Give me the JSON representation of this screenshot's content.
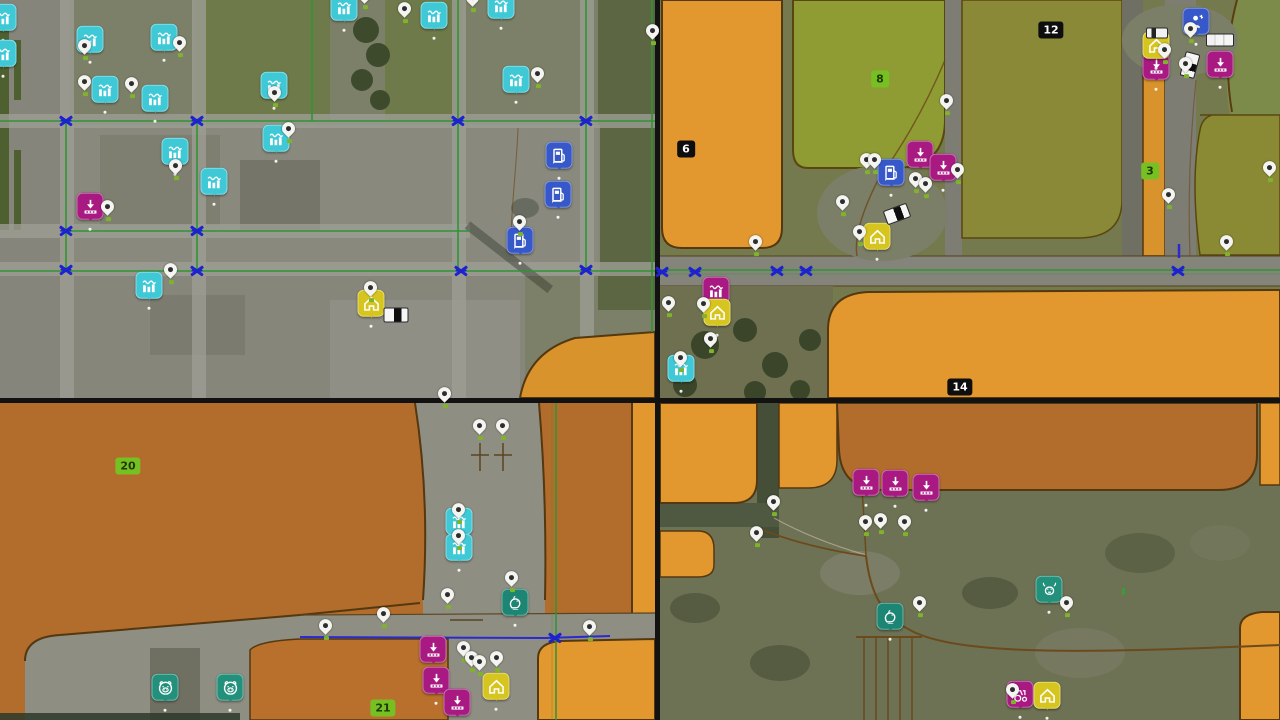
{
  "map": {
    "description": "four-view game map collage",
    "colors": {
      "cyan": "#3fc9d6",
      "blue": "#3758c8",
      "magenta": "#a81a82",
      "yellow": "#d6c51f",
      "teal": "#23907c",
      "teal_dark": "#1d8573",
      "junction_blue": "#1d22cf",
      "route_green": "#2f9435",
      "route_blue": "#2a2ad0",
      "orange_bright": "#e2972f",
      "orange_dark": "#b26c2c",
      "olive_field": "#8a8a35",
      "badge_green": "#76c023",
      "badge_dark": "#0e0e0e",
      "pin_white": "#f4f4f1"
    },
    "fields": [
      {
        "label": "6",
        "variant": "dark",
        "x": 686,
        "y": 149
      },
      {
        "label": "8",
        "variant": "green",
        "x": 880,
        "y": 79
      },
      {
        "label": "12",
        "variant": "dark",
        "x": 1051,
        "y": 30
      },
      {
        "label": "3",
        "variant": "green",
        "x": 1150,
        "y": 171
      },
      {
        "label": "14",
        "variant": "dark",
        "x": 960,
        "y": 387
      },
      {
        "label": "20",
        "variant": "green",
        "x": 128,
        "y": 466
      },
      {
        "label": "21",
        "variant": "green",
        "x": 383,
        "y": 708
      }
    ],
    "markers": [
      {
        "t": "prod",
        "x": 3,
        "y": 20
      },
      {
        "t": "prod",
        "x": 3,
        "y": 56
      },
      {
        "t": "prod",
        "x": 90,
        "y": 42
      },
      {
        "t": "prod",
        "x": 164,
        "y": 40
      },
      {
        "t": "prod",
        "x": 105,
        "y": 92
      },
      {
        "t": "prod",
        "x": 155,
        "y": 101
      },
      {
        "t": "prod",
        "x": 274,
        "y": 88
      },
      {
        "t": "prod",
        "x": 276,
        "y": 141
      },
      {
        "t": "prod",
        "x": 175,
        "y": 154
      },
      {
        "t": "prod",
        "x": 214,
        "y": 184
      },
      {
        "t": "prod",
        "x": 344,
        "y": 10
      },
      {
        "t": "prod",
        "x": 434,
        "y": 18
      },
      {
        "t": "prod",
        "x": 501,
        "y": 8
      },
      {
        "t": "prod",
        "x": 516,
        "y": 82
      },
      {
        "t": "prod",
        "x": 149,
        "y": 288
      },
      {
        "t": "fuel",
        "x": 559,
        "y": 158
      },
      {
        "t": "fuel",
        "x": 558,
        "y": 197
      },
      {
        "t": "fuel",
        "x": 520,
        "y": 243
      },
      {
        "t": "sell",
        "x": 90,
        "y": 209
      },
      {
        "t": "house",
        "x": 371,
        "y": 306
      },
      {
        "t": "ptruck",
        "x": 396,
        "y": 315,
        "r": 0
      },
      {
        "t": "jx",
        "x": 66,
        "y": 121
      },
      {
        "t": "jx",
        "x": 197,
        "y": 121
      },
      {
        "t": "jx",
        "x": 458,
        "y": 121
      },
      {
        "t": "jx",
        "x": 586,
        "y": 121
      },
      {
        "t": "jx",
        "x": 66,
        "y": 231
      },
      {
        "t": "jx",
        "x": 197,
        "y": 231
      },
      {
        "t": "jx",
        "x": 66,
        "y": 270
      },
      {
        "t": "jx",
        "x": 197,
        "y": 271
      },
      {
        "t": "jx",
        "x": 461,
        "y": 271
      },
      {
        "t": "jx",
        "x": 586,
        "y": 270
      },
      {
        "t": "pin",
        "x": 85,
        "y": 57
      },
      {
        "t": "pin",
        "x": 180,
        "y": 54
      },
      {
        "t": "pin",
        "x": 85,
        "y": 93
      },
      {
        "t": "pin",
        "x": 132,
        "y": 95
      },
      {
        "t": "pin",
        "x": 275,
        "y": 104
      },
      {
        "t": "pin",
        "x": 289,
        "y": 140
      },
      {
        "t": "pin",
        "x": 176,
        "y": 177
      },
      {
        "t": "pin",
        "x": 405,
        "y": 20
      },
      {
        "t": "pin",
        "x": 473,
        "y": 9
      },
      {
        "t": "pin",
        "x": 538,
        "y": 85
      },
      {
        "t": "pin",
        "x": 520,
        "y": 233
      },
      {
        "t": "pin",
        "x": 108,
        "y": 218
      },
      {
        "t": "pin",
        "x": 171,
        "y": 281
      },
      {
        "t": "pin",
        "x": 365,
        "y": 6
      },
      {
        "t": "pin",
        "x": 653,
        "y": 42
      },
      {
        "t": "pin",
        "x": 371,
        "y": 299
      },
      {
        "t": "prod",
        "x": 681,
        "y": 371
      },
      {
        "t": "fuel",
        "x": 891,
        "y": 175
      },
      {
        "t": "sell",
        "x": 920,
        "y": 157
      },
      {
        "t": "sell",
        "x": 943,
        "y": 170
      },
      {
        "t": "sell",
        "x": 1220,
        "y": 67
      },
      {
        "t": "sell",
        "x": 1156,
        "y": 69
      },
      {
        "t": "prodm",
        "x": 716,
        "y": 293
      },
      {
        "t": "house",
        "x": 877,
        "y": 239
      },
      {
        "t": "house",
        "x": 717,
        "y": 315
      },
      {
        "t": "house",
        "x": 1156,
        "y": 48
      },
      {
        "t": "shop",
        "x": 1196,
        "y": 24
      },
      {
        "t": "car",
        "x": 1157,
        "y": 33,
        "r": 0
      },
      {
        "t": "truck",
        "x": 1220,
        "y": 40,
        "r": 0
      },
      {
        "t": "ptruck",
        "x": 1190,
        "y": 65,
        "r": 105
      },
      {
        "t": "ptruck",
        "x": 897,
        "y": 214,
        "r": -20
      },
      {
        "t": "jx",
        "x": 662,
        "y": 272
      },
      {
        "t": "jx",
        "x": 695,
        "y": 272
      },
      {
        "t": "jx",
        "x": 777,
        "y": 271
      },
      {
        "t": "jx",
        "x": 806,
        "y": 271
      },
      {
        "t": "jx",
        "x": 1178,
        "y": 271
      },
      {
        "t": "pin",
        "x": 947,
        "y": 112
      },
      {
        "t": "pin",
        "x": 867,
        "y": 171
      },
      {
        "t": "pin",
        "x": 875,
        "y": 171
      },
      {
        "t": "pin",
        "x": 958,
        "y": 181
      },
      {
        "t": "pin",
        "x": 916,
        "y": 190
      },
      {
        "t": "pin",
        "x": 926,
        "y": 195
      },
      {
        "t": "pin",
        "x": 843,
        "y": 213
      },
      {
        "t": "pin",
        "x": 860,
        "y": 243
      },
      {
        "t": "pin",
        "x": 1165,
        "y": 61
      },
      {
        "t": "pin",
        "x": 1191,
        "y": 40
      },
      {
        "t": "pin",
        "x": 1186,
        "y": 75
      },
      {
        "t": "pin",
        "x": 1169,
        "y": 206
      },
      {
        "t": "pin",
        "x": 1227,
        "y": 253
      },
      {
        "t": "pin",
        "x": 1270,
        "y": 179
      },
      {
        "t": "pin",
        "x": 756,
        "y": 253
      },
      {
        "t": "pin",
        "x": 669,
        "y": 314
      },
      {
        "t": "pin",
        "x": 704,
        "y": 315
      },
      {
        "t": "pin",
        "x": 711,
        "y": 350
      },
      {
        "t": "pin",
        "x": 681,
        "y": 369
      },
      {
        "t": "prod",
        "x": 459,
        "y": 524
      },
      {
        "t": "prod",
        "x": 459,
        "y": 550
      },
      {
        "t": "sell",
        "x": 433,
        "y": 652
      },
      {
        "t": "sell",
        "x": 436,
        "y": 683
      },
      {
        "t": "sell",
        "x": 457,
        "y": 705
      },
      {
        "t": "house",
        "x": 496,
        "y": 689
      },
      {
        "t": "hen",
        "x": 515,
        "y": 605
      },
      {
        "t": "pig",
        "x": 165,
        "y": 690
      },
      {
        "t": "pig",
        "x": 230,
        "y": 690
      },
      {
        "t": "jx",
        "x": 555,
        "y": 638
      },
      {
        "t": "pin",
        "x": 445,
        "y": 405
      },
      {
        "t": "pin",
        "x": 480,
        "y": 437
      },
      {
        "t": "pin",
        "x": 503,
        "y": 437
      },
      {
        "t": "pin",
        "x": 512,
        "y": 589
      },
      {
        "t": "pin",
        "x": 448,
        "y": 606
      },
      {
        "t": "pin",
        "x": 384,
        "y": 625
      },
      {
        "t": "pin",
        "x": 326,
        "y": 637
      },
      {
        "t": "pin",
        "x": 464,
        "y": 659
      },
      {
        "t": "pin",
        "x": 472,
        "y": 669
      },
      {
        "t": "pin",
        "x": 480,
        "y": 673
      },
      {
        "t": "pin",
        "x": 497,
        "y": 669
      },
      {
        "t": "pin",
        "x": 590,
        "y": 638
      },
      {
        "t": "pin",
        "x": 459,
        "y": 521
      },
      {
        "t": "pin",
        "x": 459,
        "y": 547
      },
      {
        "t": "sell",
        "x": 866,
        "y": 485
      },
      {
        "t": "sell",
        "x": 895,
        "y": 486
      },
      {
        "t": "sell",
        "x": 926,
        "y": 490
      },
      {
        "t": "hen",
        "x": 890,
        "y": 619
      },
      {
        "t": "cow",
        "x": 1049,
        "y": 592
      },
      {
        "t": "trac",
        "x": 1020,
        "y": 697
      },
      {
        "t": "house",
        "x": 1047,
        "y": 698
      },
      {
        "t": "pin",
        "x": 774,
        "y": 513
      },
      {
        "t": "pin",
        "x": 757,
        "y": 544
      },
      {
        "t": "pin",
        "x": 866,
        "y": 533
      },
      {
        "t": "pin",
        "x": 881,
        "y": 531
      },
      {
        "t": "pin",
        "x": 905,
        "y": 533
      },
      {
        "t": "pin",
        "x": 920,
        "y": 614
      },
      {
        "t": "pin",
        "x": 1067,
        "y": 614
      },
      {
        "t": "pin",
        "x": 1013,
        "y": 701
      }
    ]
  }
}
